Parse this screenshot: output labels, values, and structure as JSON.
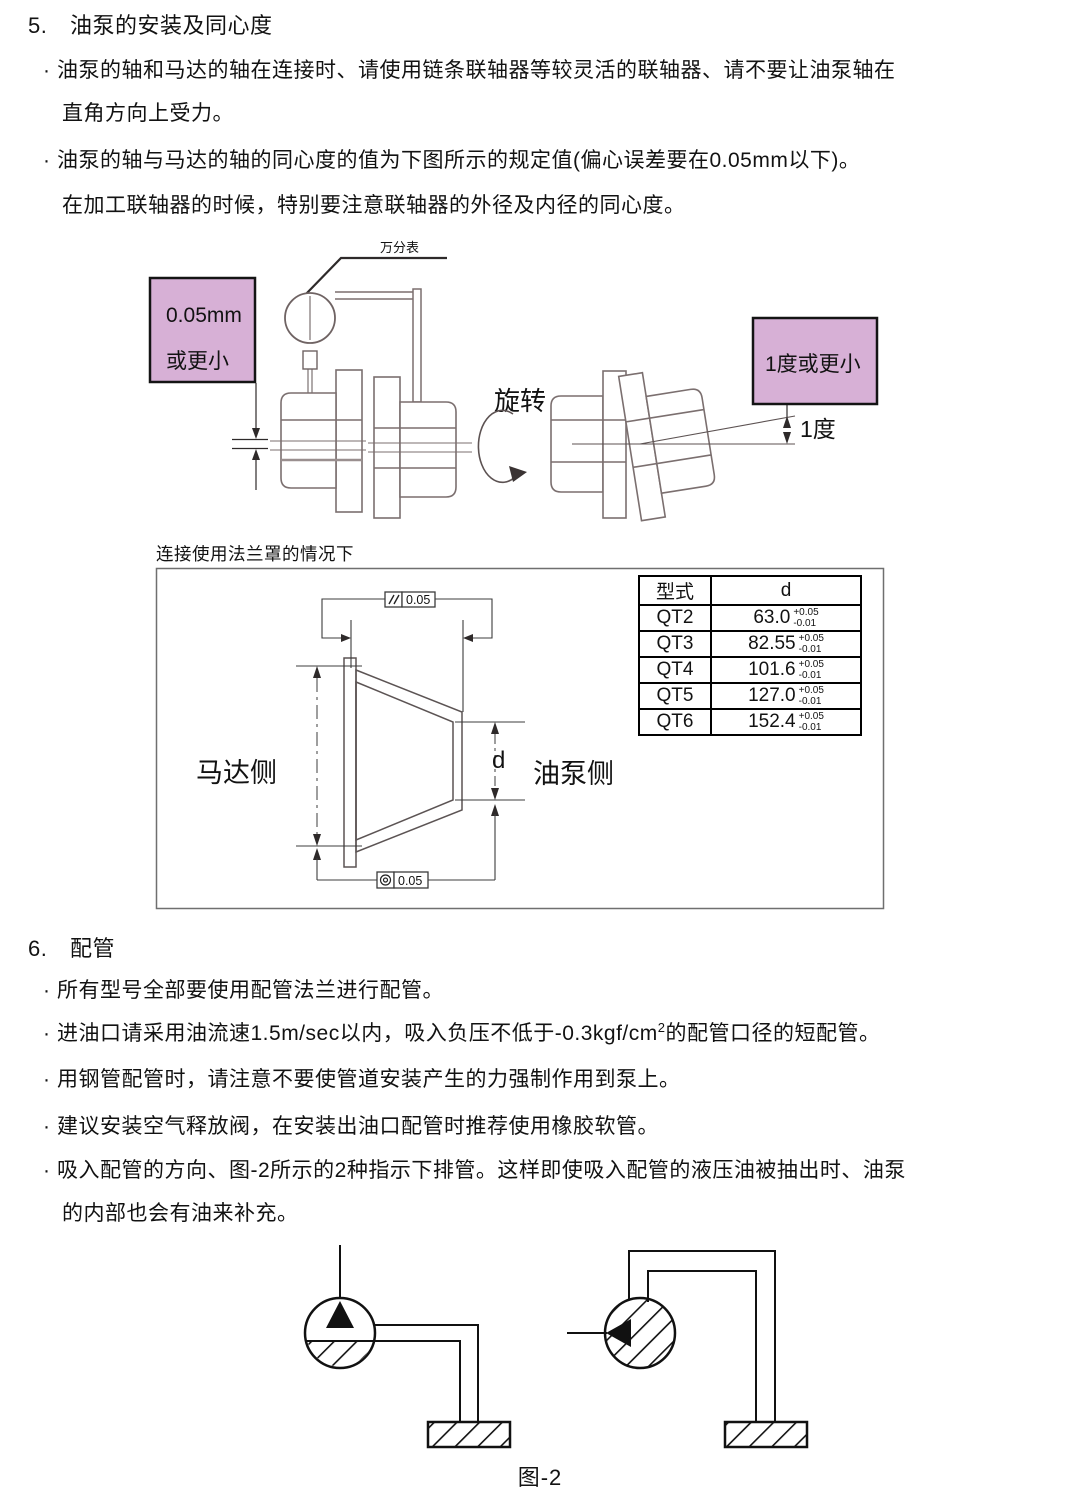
{
  "bullet": "·",
  "section5": {
    "num": "5.",
    "title": "油泵的安装及同心度",
    "b1_l1": "油泵的轴和马达的轴在连接时、请使用链条联轴器等较灵活的联轴器、请不要让油泵轴在",
    "b1_l2": "直角方向上受力。",
    "b2_l1": "油泵的轴与马达的轴的同心度的值为下图所示的规定值(偏心误差要在0.05mm以下)。",
    "b2_l2": "在加工联轴器的时候，特别要注意联轴器的外径及内径的同心度。"
  },
  "diagram1": {
    "dial_label": "万分表",
    "offset_note_line1": "0.05mm",
    "offset_note_line2": "或更小",
    "rotate_label": "旋转",
    "angle_note": "1度或更小",
    "angle_label": "1度",
    "note_fill": "#d7b0d6"
  },
  "flange": {
    "caption": "连接使用法兰罩的情况下",
    "motor_side": "马达侧",
    "pump_side": "油泵侧",
    "dim_label": "d",
    "parallelism_symbol": "//",
    "parallelism_value": "0.05",
    "concentricity_symbol": "◎",
    "concentricity_value": "0.05",
    "table": {
      "headers": [
        "型式",
        "d"
      ],
      "rows": [
        {
          "model": "QT2",
          "value": "63.0",
          "tol_plus": "+0.05",
          "tol_minus": "-0.01"
        },
        {
          "model": "QT3",
          "value": "82.55",
          "tol_plus": "+0.05",
          "tol_minus": "-0.01"
        },
        {
          "model": "QT4",
          "value": "101.6",
          "tol_plus": "+0.05",
          "tol_minus": "-0.01"
        },
        {
          "model": "QT5",
          "value": "127.0",
          "tol_plus": "+0.05",
          "tol_minus": "-0.01"
        },
        {
          "model": "QT6",
          "value": "152.4",
          "tol_plus": "+0.05",
          "tol_minus": "-0.01"
        }
      ]
    }
  },
  "section6": {
    "num": "6.",
    "title": "配管",
    "b1": "所有型号全部要使用配管法兰进行配管。",
    "b2_pre": "进油口请采用油流速1.5m/sec以内，吸入负压不低于-0.3kgf/cm",
    "b2_sup": "2",
    "b2_post": "的配管口径的短配管。",
    "b3": "用钢管配管时，请注意不要使管道安装产生的力强制作用到泵上。",
    "b4": "建议安装空气释放阀，在安装出油口配管时推荐使用橡胶软管。",
    "b5_l1": "吸入配管的方向、图-2所示的2种指示下排管。这样即使吸入配管的液压油被抽出时、油泵",
    "b5_l2": "的内部也会有油来补充。"
  },
  "figure2": {
    "caption": "图-2"
  }
}
